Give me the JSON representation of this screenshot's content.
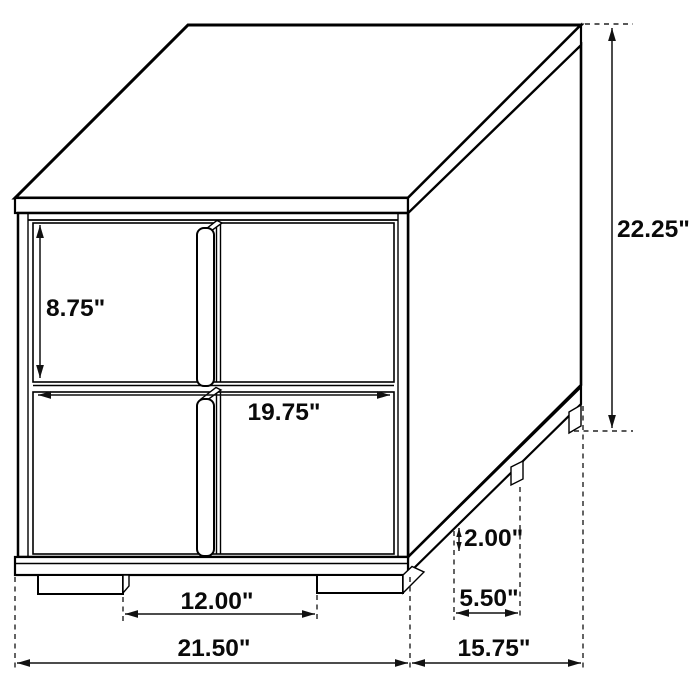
{
  "diagram": {
    "labels": {
      "overall_height": "22.25\"",
      "drawer_height": "8.75\"",
      "drawer_width": "19.75\"",
      "foot_height": "2.00\"",
      "foot_depth": "5.50\"",
      "foot_gap_width": "12.00\"",
      "overall_width": "21.50\"",
      "overall_depth": "15.75\""
    }
  },
  "colors": {
    "background": "#ffffff",
    "line": "#000000",
    "dimension_text": "#0a0a0a"
  }
}
